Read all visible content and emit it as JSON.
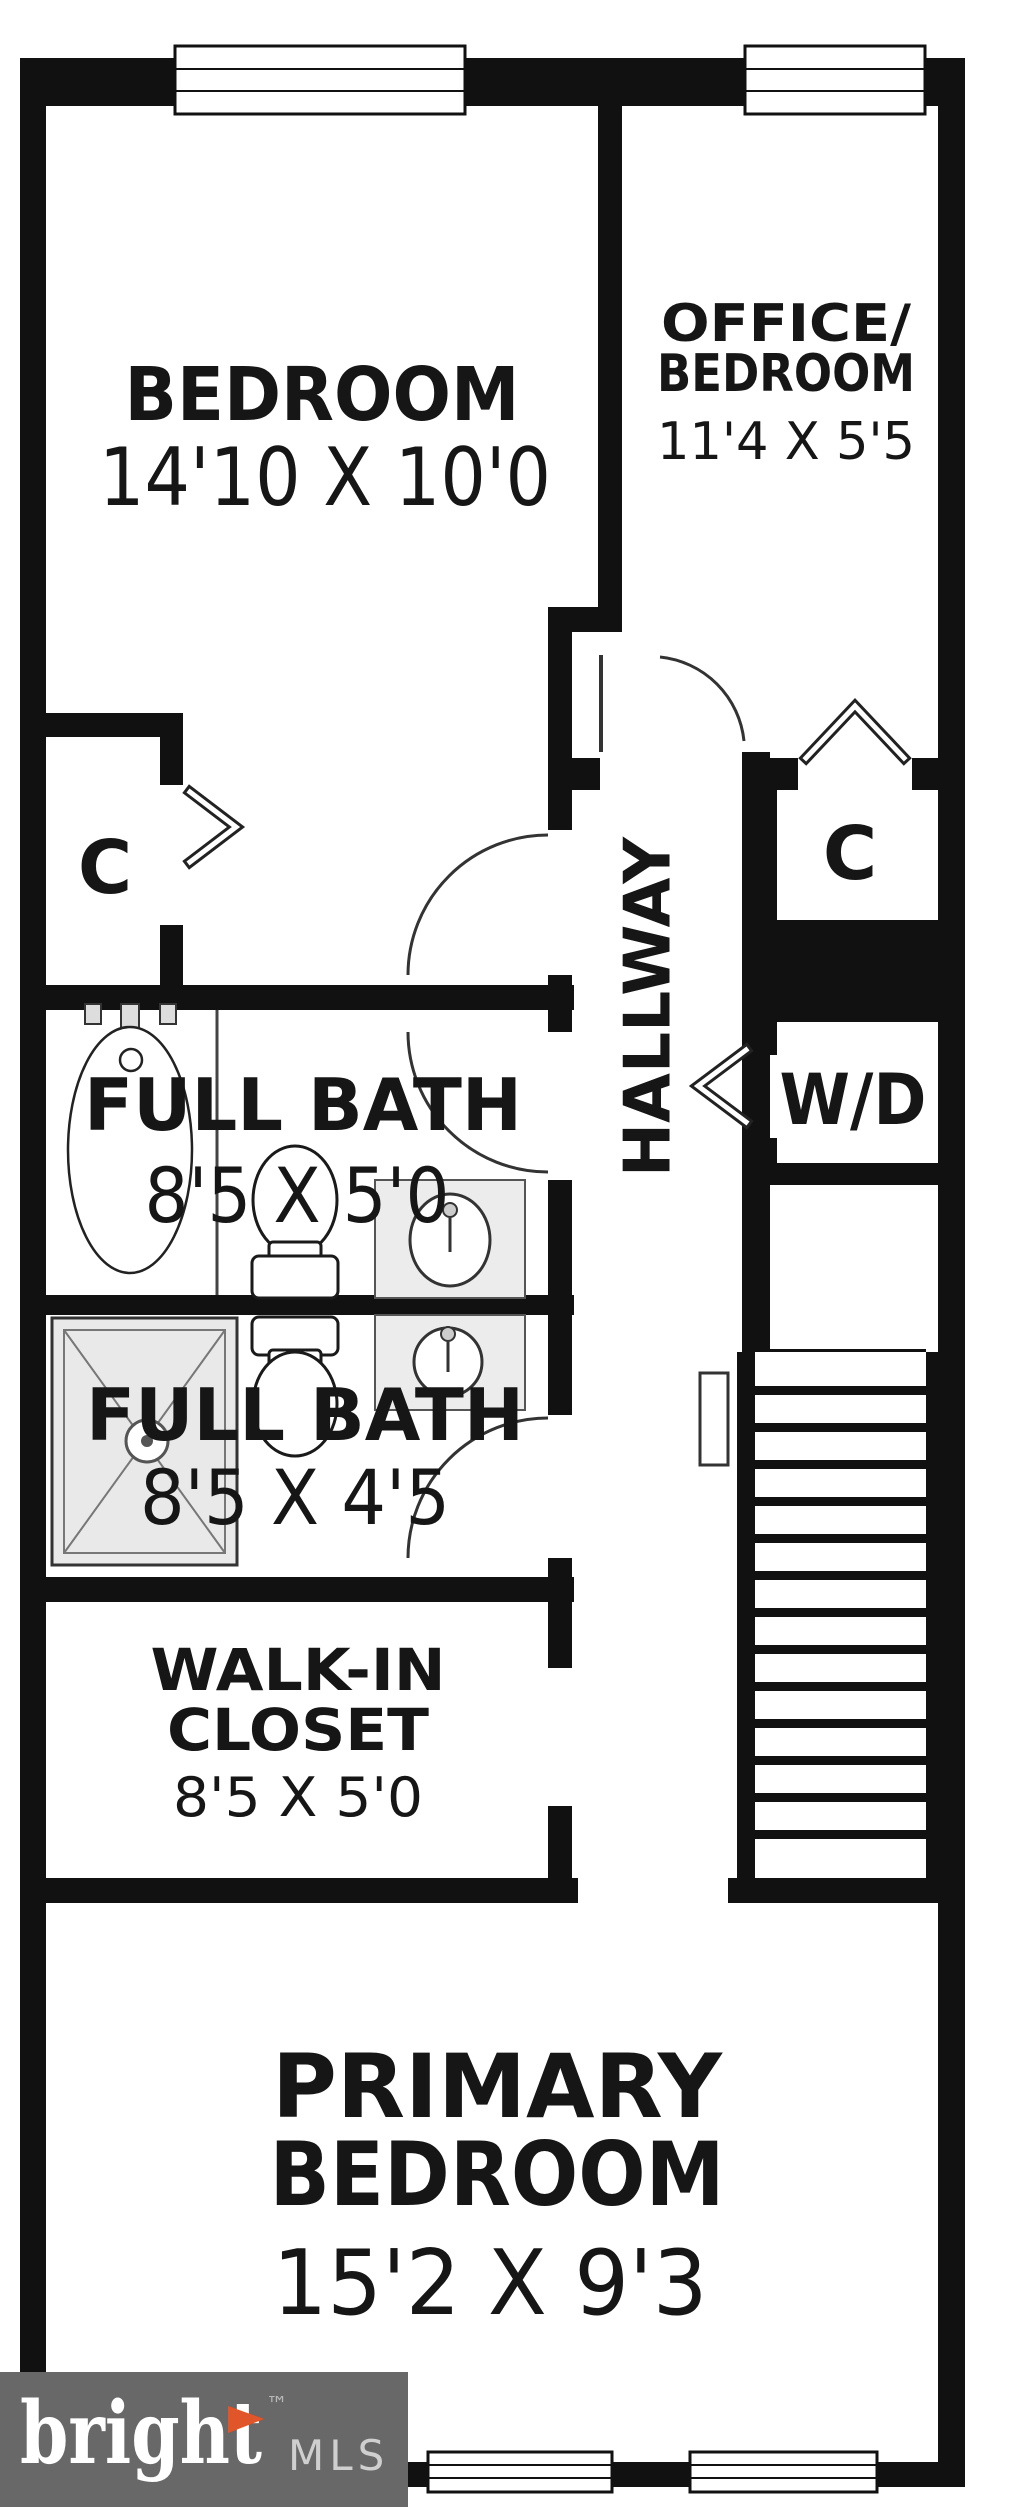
{
  "colors": {
    "wall": "#111111",
    "text": "#161616",
    "fixture_fill": "#ececec",
    "fixture_stroke": "#555555",
    "shower_fill": "#e9e9e9",
    "logo_bg": "#686868",
    "logo_text": "#ffffff",
    "logo_mls": "#cfcfcf",
    "logo_accent": "#e0552a"
  },
  "rooms": {
    "bedroom": {
      "label": "BEDROOM",
      "dims": "14'10 X 10'0"
    },
    "office": {
      "label_line1": "OFFICE/",
      "label_line2": "BEDROOM",
      "dims": "11'4 X 5'5"
    },
    "bath_upper": {
      "label": "FULL BATH",
      "dims": "8'5 X 5'0"
    },
    "bath_lower": {
      "label": "FULL BATH",
      "dims": "8'5 X 4'5"
    },
    "walk_in_closet": {
      "label_line1": "WALK-IN",
      "label_line2": "CLOSET",
      "dims": "8'5 X 5'0"
    },
    "primary": {
      "label_line1": "PRIMARY",
      "label_line2": "BEDROOM",
      "dims": "15'2 X 9'3"
    },
    "hallway": {
      "label": "HALLWAY"
    },
    "closet_left": {
      "label": "C"
    },
    "closet_right": {
      "label": "C"
    },
    "laundry": {
      "label": "W/D"
    }
  },
  "logo": {
    "brand": "bright",
    "suffix": "MLS",
    "tm": "™"
  }
}
